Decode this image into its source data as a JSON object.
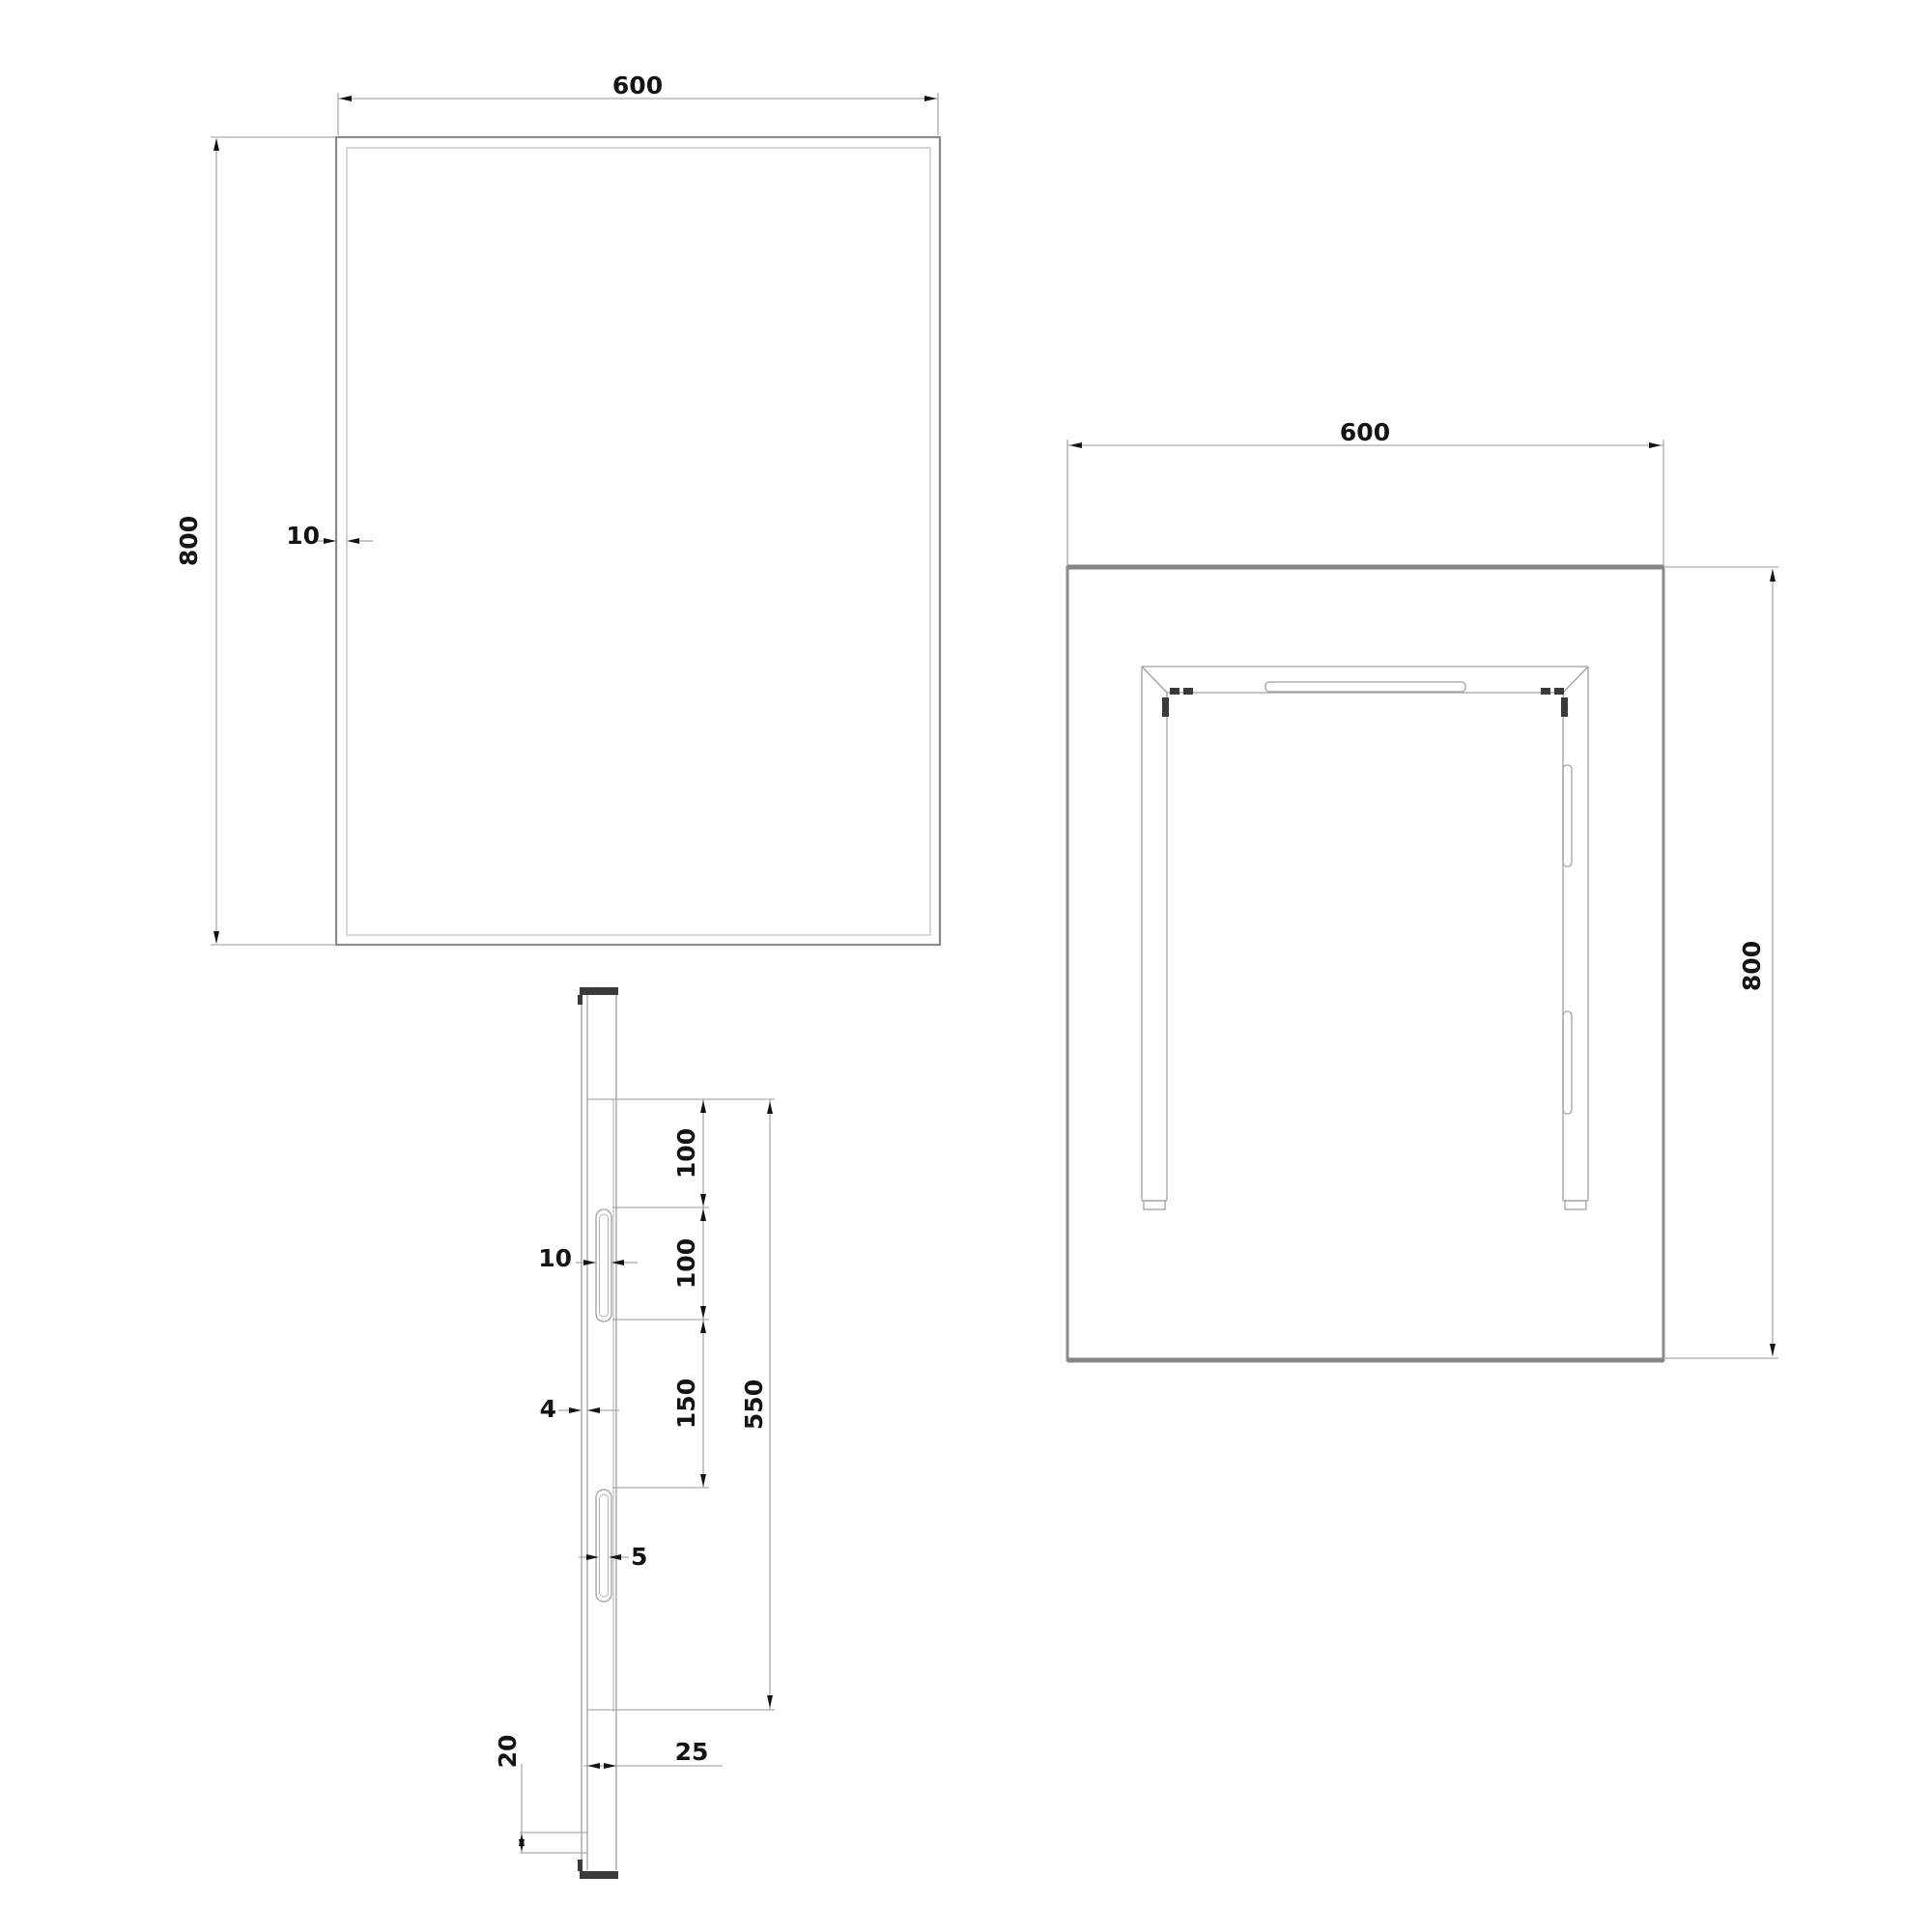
{
  "drawing": {
    "type": "technical-orthographic-drawing",
    "subject": "rectangular mirror with rear mounting frame",
    "units_implied": "mm",
    "front_view": {
      "width_label": "600",
      "height_label": "800",
      "frame_inset_label": "10"
    },
    "back_view": {
      "width_label": "600",
      "height_label": "800"
    },
    "side_view": {
      "slot_top_offset_label": "100",
      "slot_length_label": "100",
      "slot_spacing_label": "150",
      "back_panel_height_label": "550",
      "bracket_thickness_label": "10",
      "glass_thickness_label": "4",
      "slot_opening_label": "5",
      "bottom_clearance_label": "20",
      "depth_label": "25"
    }
  },
  "colors": {
    "line": "#a0a0a0",
    "line_strong": "#8a8a8a",
    "dark": "#3a3a3a",
    "text": "#141414",
    "bg": "#ffffff"
  }
}
